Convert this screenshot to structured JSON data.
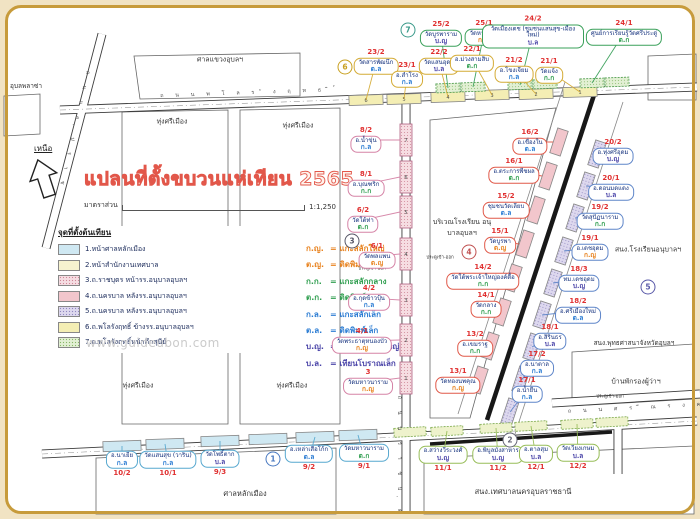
{
  "title": "แปลนที่ตั้งขบวนแห่เทียน 2565",
  "scale": {
    "label": "มาตราส่วน",
    "value": "1:1,250"
  },
  "north_label": "เหนือ",
  "watermark": "www.guideubon.com",
  "legend": {
    "header": "จุดที่ตั้งต้นเทียน",
    "items": [
      {
        "text": "1.หน้าศาลหลักเมือง",
        "swatch": "sw-blue"
      },
      {
        "text": "2.หน้าสำนักงานเทศบาล",
        "swatch": "sw-cream"
      },
      {
        "text": "3.ถ.ราชบุตร หน้ารร.อนุบาลอุบลฯ",
        "swatch": "sw-pinkdot"
      },
      {
        "text": "4.ถ.นครบาล หลังรร.อนุบาลอุบลฯ",
        "swatch": "sw-pink"
      },
      {
        "text": "5.ถ.นครบาล หลังรร.อนุบาลอุบลฯ",
        "swatch": "sw-lavdot"
      },
      {
        "text": "6.ถ.พโลรังฤทธิ์ ข้างรร.อนุบาลอุบลฯ",
        "swatch": "sw-yellow"
      },
      {
        "text": "7.ถ.พโลรังฤทธิ์หน้าตึกสุนีย์",
        "swatch": "sw-greendot"
      }
    ]
  },
  "type_key": [
    {
      "abbr": "ก.ญ.",
      "name": "แกะสลักใหญ่",
      "color": "#e8821e"
    },
    {
      "abbr": "ต.ญ.",
      "name": "ติดพิมพ์ใหญ่",
      "color": "#e8821e"
    },
    {
      "abbr": "ก.ก.",
      "name": "แกะสลักกลาง",
      "color": "#2f9e4f"
    },
    {
      "abbr": "ต.ก.",
      "name": "ติดพิมพ์กลาง",
      "color": "#2f9e4f"
    },
    {
      "abbr": "ก.ล.",
      "name": "แกะสลักเล็ก",
      "color": "#2b7cd3"
    },
    {
      "abbr": "ต.ล.",
      "name": "ติดพิมพ์เล็ก",
      "color": "#2b7cd3"
    },
    {
      "abbr": "บ.ญ.",
      "name": "เทียนโบราณใหญ่",
      "color": "#4a44a8"
    },
    {
      "abbr": "บ.ล.",
      "name": "เทียนโบราณเล็ก",
      "color": "#4a44a8"
    }
  ],
  "type_colors": {
    "ก.ญ": "#e8821e",
    "ต.ญ": "#e8821e",
    "ก.ก": "#2f9e4f",
    "ต.ก": "#2f9e4f",
    "ก.ล": "#2b7cd3",
    "ต.ล": "#2b7cd3",
    "บ.ญ": "#4a44a8",
    "บ.ล": "#4a44a8"
  },
  "groups": {
    "greentop": "#3aa05a",
    "yellow": "#d4ab35",
    "pink": "#d583a6",
    "red": "#e05848",
    "blue": "#5f86c9",
    "cyan": "#57a8cf",
    "greenbot": "#97bd58"
  },
  "labels": [
    {
      "num": "25/2",
      "name": "วัดบูรพาราม",
      "type": "บ.ญ",
      "grp": "greentop",
      "x": 441,
      "y": 34,
      "tx": 448,
      "ty": 88
    },
    {
      "num": "25/1",
      "name": "วัดหายโศก",
      "type": "ก.ญ",
      "grp": "greentop",
      "x": 484,
      "y": 33,
      "tx": 473,
      "ty": 87
    },
    {
      "num": "24/2",
      "name": "วัดเมืองเดช (ชุมชนแสนสุข-เมืองใหม่)",
      "type": "บ.ล",
      "grp": "greentop",
      "x": 533,
      "y": 32,
      "w": 92,
      "tx": 520,
      "ty": 85
    },
    {
      "num": "24/1",
      "name": "ศูนย์การเรียนรู้วัดศรีประดู่",
      "type": "ต.ก",
      "grp": "greentop",
      "x": 624,
      "y": 33,
      "tx": 592,
      "ty": 83
    },
    {
      "num": "23/2",
      "name": "วัดสารพัฒนึก",
      "type": "ต.ล",
      "grp": "yellow",
      "x": 376,
      "y": 62,
      "tx": 366,
      "ty": 100
    },
    {
      "num": "23/1",
      "name": "อ.สำโรง",
      "type": "ก.ล",
      "grp": "yellow",
      "x": 407,
      "y": 75,
      "tx": 404,
      "ty": 99
    },
    {
      "num": "22/2",
      "name": "วัดแสนอุดม",
      "type": "บ.ล",
      "grp": "yellow",
      "x": 439,
      "y": 62,
      "tx": 448,
      "ty": 97
    },
    {
      "num": "22/1",
      "name": "อ.ม่วงสามสิบ",
      "type": "ต.ก",
      "grp": "yellow",
      "x": 472,
      "y": 59,
      "tx": 492,
      "ty": 95
    },
    {
      "num": "21/2",
      "name": "อ.โขงเจียม",
      "type": "ก.ล",
      "grp": "yellow",
      "x": 514,
      "y": 70,
      "tx": 536,
      "ty": 94
    },
    {
      "num": "21/1",
      "name": "วัดแจ้ง",
      "type": "ก.ก",
      "grp": "yellow",
      "x": 549,
      "y": 71,
      "tx": 580,
      "ty": 92
    },
    {
      "num": "8/2",
      "name": "อ.น้ำขุ่น",
      "type": "ก.ล",
      "grp": "pink",
      "x": 366,
      "y": 140,
      "tx": 400,
      "ty": 140
    },
    {
      "num": "8/1",
      "name": "อ.บุณฑริก",
      "type": "ก.ก",
      "grp": "pink",
      "x": 366,
      "y": 184,
      "tx": 400,
      "ty": 177
    },
    {
      "num": "6/2",
      "name": "วัดใต้ท่า",
      "type": "ต.ก",
      "grp": "pink",
      "x": 363,
      "y": 220,
      "tx": 400,
      "ty": 212
    },
    {
      "num": "6/1",
      "name": "วัดพลแพน",
      "type": "ต.ญ",
      "grp": "pink",
      "x": 377,
      "y": 256,
      "tx": 400,
      "ty": 254
    },
    {
      "num": "4/2",
      "name": "อ.กุดข้าวปุ้น",
      "type": "ก.ล",
      "grp": "pink",
      "x": 369,
      "y": 298,
      "tx": 400,
      "ty": 300
    },
    {
      "num": "4/1",
      "name": "วัดพระธาตุหนองบัว",
      "type": "ก.ญ",
      "grp": "pink",
      "x": 362,
      "y": 341,
      "tx": 400,
      "ty": 340
    },
    {
      "num": "3",
      "name": "วัดมหาวนาราม",
      "type": "ก.ญ",
      "grp": "pink",
      "x": 368,
      "y": 382,
      "tx": 400,
      "ty": 378
    },
    {
      "num": "16/2",
      "name": "อ.เขื่องใน",
      "type": "ต.ล",
      "grp": "red",
      "x": 530,
      "y": 142,
      "tx": 553,
      "ty": 142
    },
    {
      "num": "16/1",
      "name": "อ.ตระการพืชผล",
      "type": "ต.ก",
      "grp": "red",
      "x": 514,
      "y": 171,
      "tx": 542,
      "ty": 176
    },
    {
      "num": "15/2",
      "name": "ชุมชนวัดเลียบ",
      "type": "ต.ล",
      "grp": "red",
      "x": 506,
      "y": 206,
      "tx": 530,
      "ty": 210
    },
    {
      "num": "15/1",
      "name": "วัดบูรพา",
      "type": "ต.ญ",
      "grp": "red",
      "x": 500,
      "y": 241,
      "tx": 519,
      "ty": 244
    },
    {
      "num": "14/2",
      "name": "วัดใต้พระเจ้าใหญ่องค์ตื้อ",
      "type": "ก.ก",
      "grp": "red",
      "x": 483,
      "y": 277,
      "tx": 507,
      "ty": 278
    },
    {
      "num": "14/1",
      "name": "วัดกลาง",
      "type": "ก.ก",
      "grp": "red",
      "x": 486,
      "y": 305,
      "tx": 496,
      "ty": 312
    },
    {
      "num": "13/2",
      "name": "อ.เขมราฐ",
      "type": "ก.ก",
      "grp": "red",
      "x": 475,
      "y": 344,
      "tx": 484,
      "ty": 346
    },
    {
      "num": "13/1",
      "name": "วัดทองนพคุณ",
      "type": "ก.ญ",
      "grp": "red",
      "x": 458,
      "y": 381,
      "tx": 473,
      "ty": 380
    },
    {
      "num": "20/2",
      "name": "อ.ทุ่งศรีอุดม",
      "type": "บ.ญ",
      "grp": "blue",
      "x": 613,
      "y": 152,
      "tx": 597,
      "ty": 154
    },
    {
      "num": "20/1",
      "name": "อ.ดอนมดแดง",
      "type": "บ.ล",
      "grp": "blue",
      "x": 611,
      "y": 188,
      "tx": 586,
      "ty": 186
    },
    {
      "num": "19/2",
      "name": "วัดสุปัฏนาราม",
      "type": "ก.ก",
      "grp": "blue",
      "x": 600,
      "y": 217,
      "tx": 575,
      "ty": 218
    },
    {
      "num": "19/1",
      "name": "อ.เดชอุดม",
      "type": "ก.ญ",
      "grp": "blue",
      "x": 590,
      "y": 248,
      "tx": 564,
      "ty": 251
    },
    {
      "num": "18/3",
      "name": "ทม.เดชอุดม",
      "type": "บ.ญ",
      "grp": "blue",
      "x": 579,
      "y": 279,
      "tx": 553,
      "ty": 283
    },
    {
      "num": "18/2",
      "name": "อ.ศรีเมืองใหม่",
      "type": "ต.ล",
      "grp": "blue",
      "x": 578,
      "y": 311,
      "tx": 542,
      "ty": 315
    },
    {
      "num": "18/1",
      "name": "อ.สิรินธร",
      "type": "บ.ล",
      "grp": "blue",
      "x": 550,
      "y": 337,
      "tx": 532,
      "ty": 347
    },
    {
      "num": "17/2",
      "name": "อ.นาตาล",
      "type": "ก.ล",
      "grp": "blue",
      "x": 537,
      "y": 364,
      "tx": 521,
      "ty": 380
    },
    {
      "num": "17/1",
      "name": "อ.น้ำยืน",
      "type": "ก.ล",
      "grp": "blue",
      "x": 527,
      "y": 390,
      "tx": 510,
      "ty": 412
    },
    {
      "num": "10/2",
      "name": "อ.นาเยีย",
      "type": "ก.ล",
      "grp": "cyan",
      "x": 122,
      "y": 464,
      "side": "below",
      "tx": 122,
      "ty": 446
    },
    {
      "num": "10/1",
      "name": "วัดแสนสุข (วาริน)",
      "type": "ก.ล",
      "grp": "cyan",
      "x": 168,
      "y": 464,
      "side": "below",
      "tx": 165,
      "ty": 444
    },
    {
      "num": "9/3",
      "name": "วัดโพธิ์ตาก",
      "type": "บ.ล",
      "grp": "cyan",
      "x": 220,
      "y": 463,
      "side": "below",
      "tx": 220,
      "ty": 441
    },
    {
      "num": "9/2",
      "name": "อ.เหล่าเสือโก้ก",
      "type": "ต.ล",
      "grp": "cyan",
      "x": 309,
      "y": 458,
      "side": "below",
      "tx": 315,
      "ty": 437
    },
    {
      "num": "9/1",
      "name": "วัดมหาวนาราม",
      "type": "ต.ก",
      "grp": "cyan",
      "x": 364,
      "y": 457,
      "side": "below",
      "tx": 358,
      "ty": 435
    },
    {
      "num": "11/1",
      "name": "อ.สว่างวีระวงศ์",
      "type": "บ.ญ",
      "grp": "greenbot",
      "x": 443,
      "y": 459,
      "side": "below",
      "tx": 447,
      "ty": 431
    },
    {
      "num": "11/2",
      "name": "อ.พิบูลมังสาหาร",
      "type": "บ.ญ",
      "grp": "greenbot",
      "x": 498,
      "y": 459,
      "side": "below",
      "tx": 496,
      "ty": 428
    },
    {
      "num": "12/1",
      "name": "อ.ตาลสุม",
      "type": "บ.ล",
      "grp": "greenbot",
      "x": 536,
      "y": 458,
      "side": "below",
      "tx": 531,
      "ty": 426
    },
    {
      "num": "12/2",
      "name": "วัดเวียงเกษม",
      "type": "บ.ล",
      "grp": "greenbot",
      "x": 578,
      "y": 457,
      "side": "below",
      "tx": 577,
      "ty": 424
    }
  ],
  "circles": [
    {
      "n": "1",
      "x": 273,
      "y": 459,
      "c": "#4878c0"
    },
    {
      "n": "2",
      "x": 510,
      "y": 440,
      "c": "#666677"
    },
    {
      "n": "3",
      "x": 352,
      "y": 241,
      "c": "#555566"
    },
    {
      "n": "4",
      "x": 469,
      "y": 252,
      "c": "#c05050"
    },
    {
      "n": "5",
      "x": 648,
      "y": 287,
      "c": "#5858a8"
    },
    {
      "n": "6",
      "x": 345,
      "y": 67,
      "c": "#c8a020"
    },
    {
      "n": "7",
      "x": 408,
      "y": 30,
      "c": "#3a9a8a"
    }
  ],
  "places": [
    {
      "text": "อุบลพลาซ่า",
      "x": 26,
      "y": 86
    },
    {
      "text": "ศาลแขวงอุบลฯ",
      "x": 220,
      "y": 60,
      "size": 7
    },
    {
      "text": "ทุ่งศรีเมือง",
      "x": 172,
      "y": 122,
      "size": 7
    },
    {
      "text": "ทุ่งศรีเมือง",
      "x": 298,
      "y": 126,
      "size": 7
    },
    {
      "text": "ทุ่งศรีเมือง",
      "x": 138,
      "y": 386,
      "size": 7
    },
    {
      "text": "ทุ่งศรีเมือง",
      "x": 292,
      "y": 386,
      "size": 7
    },
    {
      "text": "ศาลหลักเมือง",
      "x": 245,
      "y": 494,
      "size": 7.5
    },
    {
      "text": "สนง.เทศบาลนครอุบลราชธานี",
      "x": 523,
      "y": 492,
      "size": 7.5
    },
    {
      "text": "บริเวณโรงเรียน อนุบาลอุบลฯ",
      "x": 462,
      "y": 228,
      "w": 64,
      "size": 7
    },
    {
      "text": "สนง.โรงเรียนอนุบาลฯ",
      "x": 648,
      "y": 250,
      "w": 72,
      "size": 7
    },
    {
      "text": "สนง.พุทธศาสนาจังหวัดอุบลฯ",
      "x": 634,
      "y": 343,
      "size": 6.5
    },
    {
      "text": "บ้านพักรองผู้ว่าฯ",
      "x": 636,
      "y": 382,
      "size": 7
    },
    {
      "text": "ประตูเข้า-ออก",
      "x": 372,
      "y": 268,
      "size": 4.5
    },
    {
      "text": "ประตูเข้า-ออก",
      "x": 440,
      "y": 257,
      "size": 4.5
    },
    {
      "text": "ประตูเข้า-ออก",
      "x": 610,
      "y": 396,
      "size": 4.5
    }
  ],
  "streets": [
    {
      "name": "ถนนพโลรังฤทธิ์",
      "x": 250,
      "y": 93,
      "rot": -2
    },
    {
      "name": "ถนนอุปราช",
      "x": 74,
      "y": 130,
      "rot": 103
    },
    {
      "name": "ถนนศรีณรงค์",
      "x": 640,
      "y": 408,
      "rot": -3
    },
    {
      "name": "ถนนราชบุตร",
      "x": 399,
      "y": 464,
      "rot": 90
    }
  ],
  "boxes": {
    "top_yellow": [
      {
        "x": 366,
        "y": 100,
        "n": "6"
      },
      {
        "x": 404,
        "y": 99,
        "n": "5"
      },
      {
        "x": 448,
        "y": 97,
        "n": "4"
      },
      {
        "x": 492,
        "y": 95,
        "n": "3"
      },
      {
        "x": 536,
        "y": 94,
        "n": "2"
      },
      {
        "x": 580,
        "y": 92,
        "n": "1"
      }
    ],
    "top_green": [
      {
        "x": 448,
        "y": 88
      },
      {
        "x": 473,
        "y": 87
      },
      {
        "x": 520,
        "y": 85
      },
      {
        "x": 545,
        "y": 84
      },
      {
        "x": 592,
        "y": 83
      },
      {
        "x": 617,
        "y": 82
      }
    ],
    "ratchabut": [
      {
        "x": 406,
        "y": 140,
        "n": "7"
      },
      {
        "x": 406,
        "y": 177,
        "n": "6"
      },
      {
        "x": 406,
        "y": 212,
        "n": "5"
      },
      {
        "x": 406,
        "y": 254,
        "n": "4"
      },
      {
        "x": 406,
        "y": 300,
        "n": "3"
      },
      {
        "x": 406,
        "y": 340,
        "n": "2"
      },
      {
        "x": 406,
        "y": 378,
        "n": "1"
      }
    ],
    "diag_pink": [
      {
        "x": 559,
        "y": 142
      },
      {
        "x": 548,
        "y": 176
      },
      {
        "x": 536,
        "y": 210
      },
      {
        "x": 525,
        "y": 244
      },
      {
        "x": 513,
        "y": 278
      },
      {
        "x": 502,
        "y": 312
      },
      {
        "x": 490,
        "y": 346
      },
      {
        "x": 479,
        "y": 380
      }
    ],
    "diag_lav": [
      {
        "x": 597,
        "y": 154
      },
      {
        "x": 586,
        "y": 186
      },
      {
        "x": 575,
        "y": 218
      },
      {
        "x": 564,
        "y": 251
      },
      {
        "x": 553,
        "y": 283
      },
      {
        "x": 542,
        "y": 315
      },
      {
        "x": 532,
        "y": 347
      },
      {
        "x": 521,
        "y": 380
      },
      {
        "x": 510,
        "y": 412
      }
    ],
    "bottom_blue": [
      {
        "x": 122,
        "y": 446
      },
      {
        "x": 165,
        "y": 444
      },
      {
        "x": 220,
        "y": 441
      },
      {
        "x": 268,
        "y": 439
      },
      {
        "x": 315,
        "y": 437
      },
      {
        "x": 358,
        "y": 435
      }
    ],
    "bottom_green": [
      {
        "x": 410,
        "y": 432
      },
      {
        "x": 447,
        "y": 431
      },
      {
        "x": 496,
        "y": 428
      },
      {
        "x": 531,
        "y": 426
      },
      {
        "x": 577,
        "y": 424
      },
      {
        "x": 612,
        "y": 422
      }
    ]
  }
}
